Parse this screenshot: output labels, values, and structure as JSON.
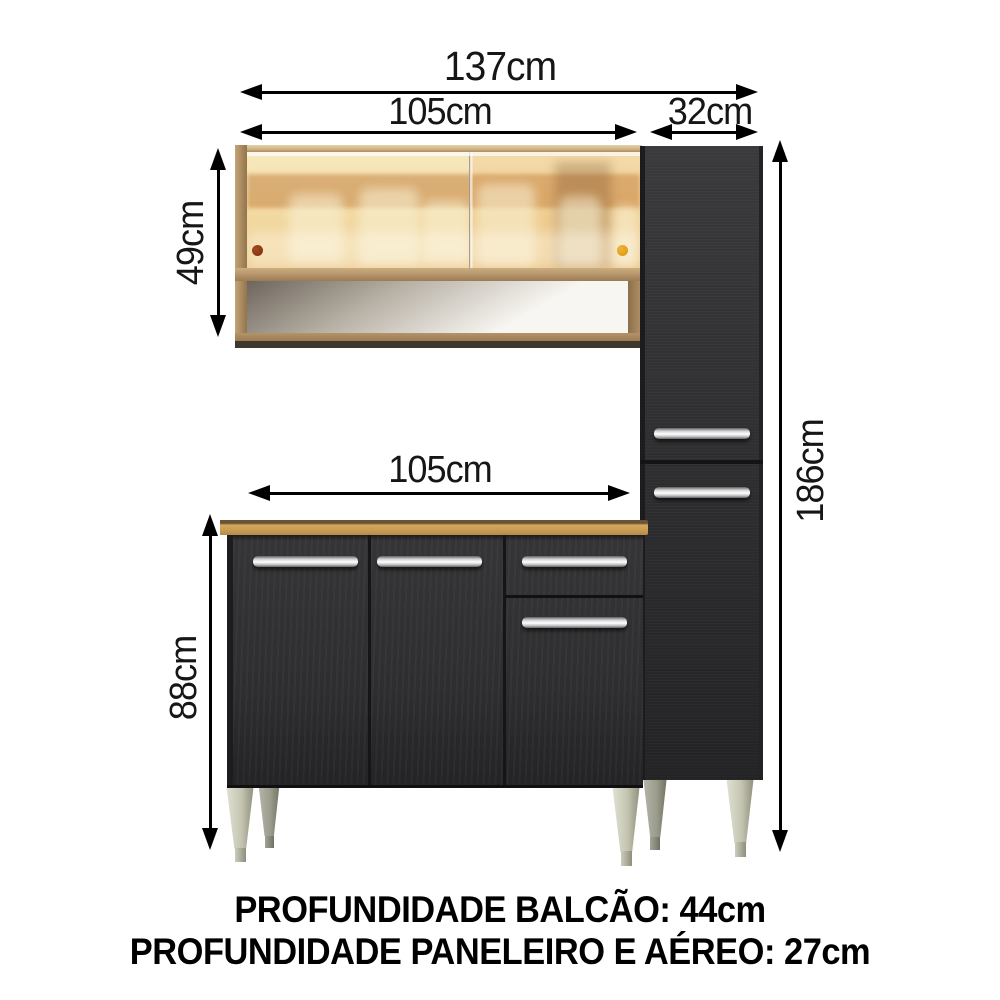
{
  "diagram": {
    "dimension_labels": {
      "total_width": "137cm",
      "upper_cabinet_width": "105cm",
      "tall_cabinet_width": "32cm",
      "upper_cabinet_height": "49cm",
      "tall_cabinet_height": "186cm",
      "base_cabinet_width": "105cm",
      "base_cabinet_height": "88cm"
    },
    "footer": {
      "balcao_depth": "PROFUNDIDADE BALCÃO: 44cm",
      "paneleiro_aereo_depth": "PROFUNDIDADE PANELEIRO E AÉREO: 27cm"
    },
    "colors": {
      "dimension_line": "#000000",
      "label_text": "#161616",
      "wood_frame": "#b5926a",
      "wood_light": "#cfb384",
      "wood_dark": "#93754c",
      "countertop_face": "#c89a52",
      "countertop_edge": "#6d5335",
      "cabinet_black": "#2e2e30",
      "cabinet_black_dark": "#1c1c1e",
      "glass_cream": "#f7e9c0",
      "glass_amber": "#eecd92",
      "amber_band": "#c07c3c",
      "knob_red": "#7d2d10",
      "knob_orange": "#d9940a",
      "leg_light": "#e2e2d4",
      "leg_dark": "#8f8f7c",
      "niche_shadow": "#6e665c",
      "niche_light": "#f8f6f2"
    }
  }
}
